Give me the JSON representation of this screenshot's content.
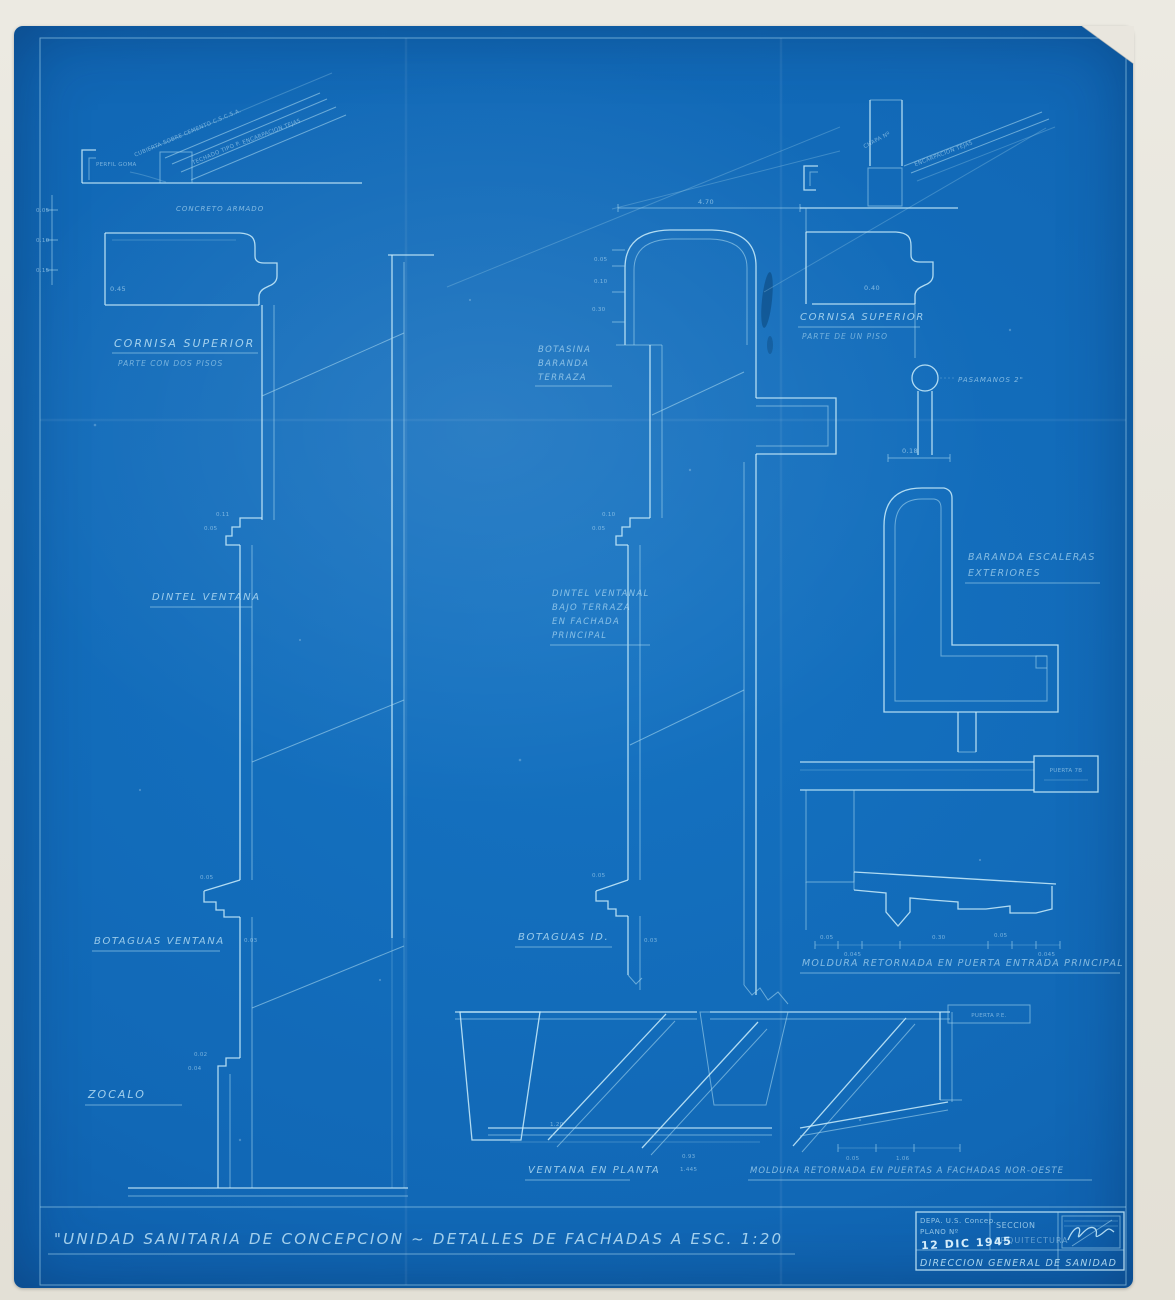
{
  "sheet": {
    "title": "\"UNIDAD SANITARIA DE CONCEPCION ~ DETALLES DE FACHADAS A ESC. 1:20"
  },
  "details": {
    "left_cornice": {
      "roof_note1": "CUBIERTA SOBRE CEMENTO C.S.C.S.A.",
      "roof_note2": "TECHADO TIPO P.",
      "roof_note3": "ENCARPACION TEJAS",
      "gutter_label": "PERFIL GOMA",
      "material": "CONCRETO ARMADO",
      "dim_height": "0.45",
      "side_dims": [
        "0.05",
        "0.10",
        "0.15"
      ],
      "title1": "CORNISA SUPERIOR",
      "title2": "PARTE CON DOS PISOS"
    },
    "lintel_left": {
      "label": "DINTEL VENTANA",
      "dim1": "0.11",
      "dim2": "0.05"
    },
    "sill_left": {
      "label": "BOTAGUAS VENTANA",
      "dim1": "0.05",
      "dim2": "0.03"
    },
    "base_left": {
      "label": "ZOCALO",
      "dim1": "0.02",
      "dim2": "0.04"
    },
    "parapet_mid": {
      "title1": "BOTASINA",
      "title2": "BARANDA",
      "title3": "TERRAZA",
      "dim_top": "4.70",
      "side_dims": [
        "0.05",
        "0.10",
        "0.30"
      ],
      "lintel_dim1": "0.10",
      "lintel_dim2": "0.05"
    },
    "lintel_mid": {
      "line1": "DINTEL VENTANAL",
      "line2": "BAJO TERRAZA",
      "line3": "EN FACHADA",
      "line4": "PRINCIPAL"
    },
    "sill_mid": {
      "label": "BOTAGUAS ID.",
      "dim1": "0.05",
      "dim2": "0.03"
    },
    "cornice_right": {
      "roof_note1": "CHAPA Nº",
      "roof_note2": "ENCARPACION TEJAS",
      "title1": "CORNISA SUPERIOR",
      "title2": "PARTE DE UN PISO",
      "dim": "0.40"
    },
    "handrail": {
      "label": "PASAMANOS 2\"",
      "dim": "0.18"
    },
    "stair_rail": {
      "title1": "BARANDA ESCALERAS",
      "title2": "EXTERIORES"
    },
    "door_molding": {
      "title": "MOLDURA RETORNADA EN PUERTA ENTRADA PRINCIPAL",
      "door_tag": "PUERTA 7B",
      "dims": [
        "0.05",
        "0.045",
        "0.30",
        "0.05",
        "0.045"
      ]
    },
    "window_plan": {
      "title": "VENTANA EN PLANTA",
      "dims": [
        "1.20",
        "0.93",
        "1.445"
      ]
    },
    "nw_molding": {
      "title": "MOLDURA RETORNADA EN PUERTAS A FACHADAS NOR-OESTE",
      "door_tag": "PUERTA P.E.",
      "dims": [
        "0.05",
        "1.06"
      ]
    }
  },
  "title_block": {
    "dept": "DEPA. U.S. Concep.",
    "plan_no": "PLANO Nº",
    "date_stamp": "12 DIC 1945",
    "section_label": "SECCION",
    "section_value": "ARQUITECTURA",
    "org": "DIRECCION GENERAL DE SANIDAD"
  }
}
